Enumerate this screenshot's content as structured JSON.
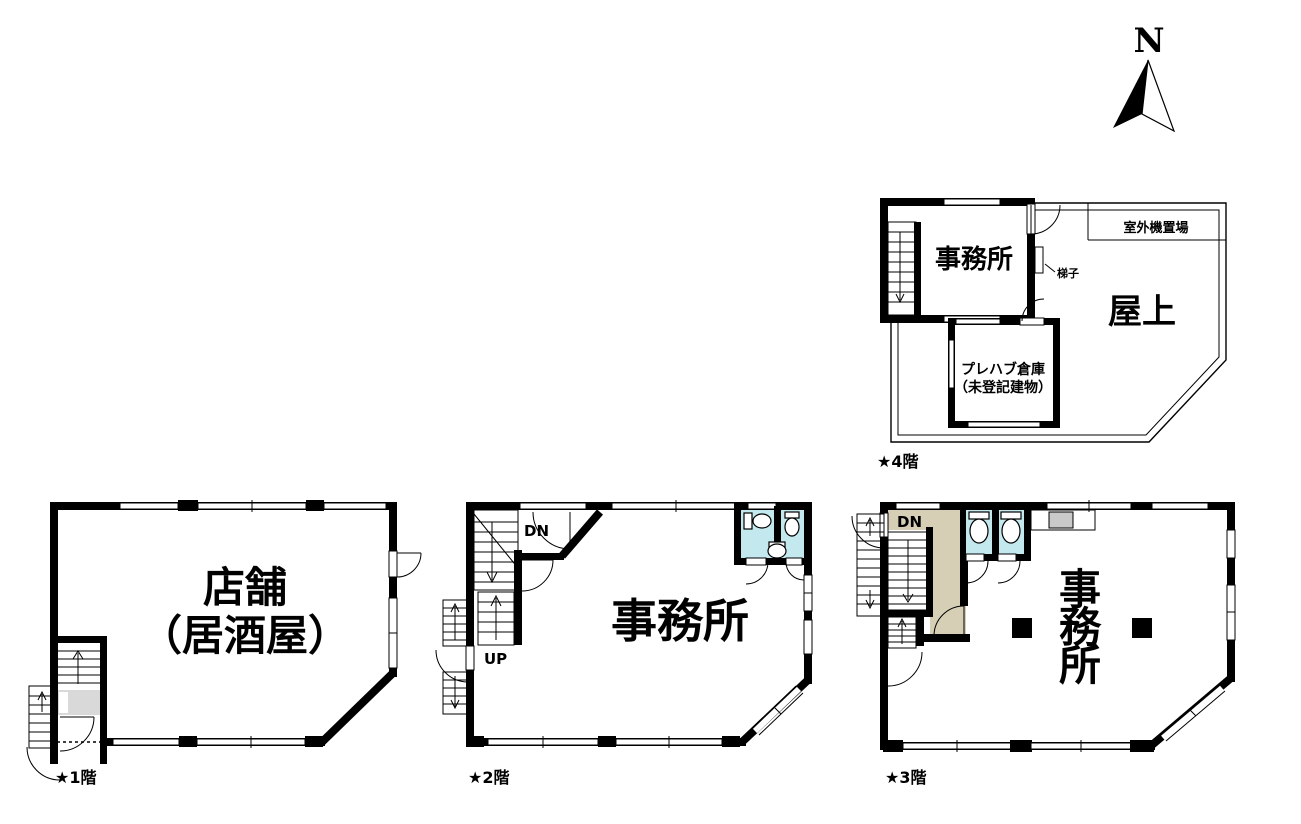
{
  "compass": {
    "label": "N"
  },
  "colors": {
    "line": "#000000",
    "toilet_room": "#c3e9ee",
    "hallway_3f": "#d6cfb5",
    "landing_1f": "#d9d9d9",
    "sink_counter": "#c9c9c9"
  },
  "floor1": {
    "label": "★1階",
    "room_shop_line1": "店舗",
    "room_shop_line2": "（居酒屋）"
  },
  "floor2": {
    "label": "★2階",
    "room_office": "事務所",
    "stair_down": "DN",
    "stair_up": "UP"
  },
  "floor3": {
    "label": "★3階",
    "stair_down": "DN",
    "office_chars": [
      "事",
      "務",
      "所"
    ]
  },
  "floor4": {
    "label": "★4階",
    "room_office": "事務所",
    "room_rooftop": "屋上",
    "prefab_line1": "プレハブ倉庫",
    "prefab_line2": "（未登記建物）",
    "outdoor_unit_area": "室外機置場",
    "ladder": "梯子"
  }
}
